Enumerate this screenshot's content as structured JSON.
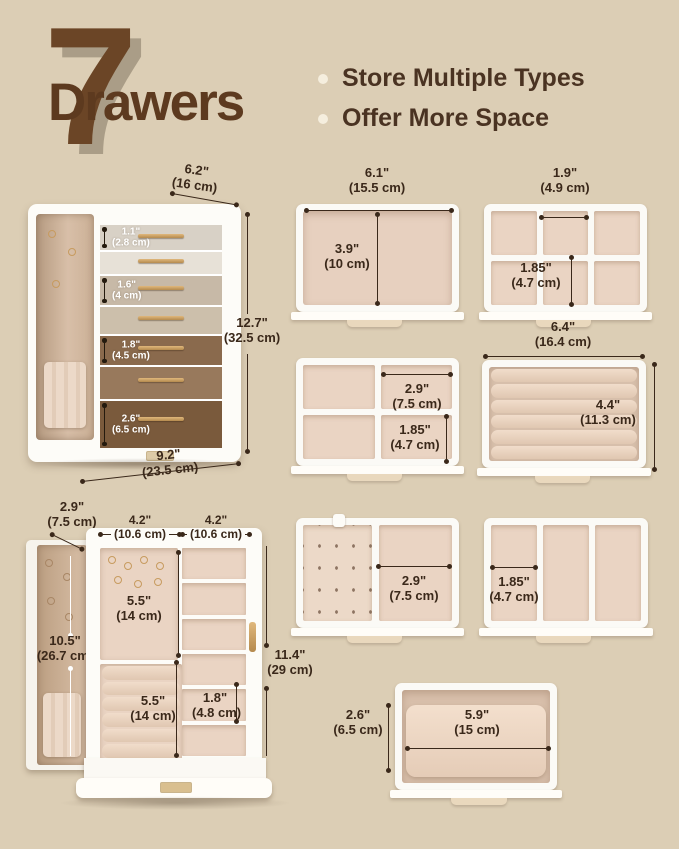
{
  "colors": {
    "background": "#dcceb5",
    "brown": "#5d3a1f",
    "line": "#3a281a",
    "velvet": "#ead4c3",
    "gold": "#c79b5f",
    "white": "#ffffff"
  },
  "header": {
    "number": "7",
    "word": "Drawers",
    "bullets": [
      {
        "label": "Store Multiple Types"
      },
      {
        "label": "Offer More Space"
      }
    ]
  },
  "closed_box": {
    "width_top": {
      "inch": "6.2\"",
      "cm": "(16 cm)"
    },
    "height": {
      "inch": "12.7\"",
      "cm": "(32.5 cm)"
    },
    "width_bottom": {
      "inch": "9.2\"",
      "cm": "(23.5 cm)"
    },
    "drawer_heights": [
      {
        "inch": "1.1\"",
        "cm": "(2.8 cm)"
      },
      {
        "inch": "1.6\"",
        "cm": "(4 cm)"
      },
      {
        "inch": "1.8\"",
        "cm": "(4.5 cm)"
      },
      {
        "inch": "2.6\"",
        "cm": "(6.5 cm)"
      }
    ]
  },
  "trays": {
    "tray1": {
      "width_inch": "6.1\"",
      "width_cm": "(15.5 cm)",
      "depth_inch": "3.9\"",
      "depth_cm": "(10 cm)"
    },
    "tray2": {
      "cell_width_inch": "1.9\"",
      "cell_width_cm": "(4.9 cm)",
      "cell_depth_inch": "1.85\"",
      "cell_depth_cm": "(4.7 cm)"
    },
    "tray3": {
      "cell_width_inch": "2.9\"",
      "cell_width_cm": "(7.5 cm)",
      "cell_depth_inch": "1.85\"",
      "cell_depth_cm": "(4.7 cm)"
    },
    "tray4": {
      "width_inch": "6.4\"",
      "width_cm": "(16.4 cm)",
      "depth_inch": "4.4\"",
      "depth_cm": "(11.3 cm)"
    },
    "tray5": {
      "cell_width_inch": "2.9\"",
      "cell_width_cm": "(7.5 cm)"
    },
    "tray6": {
      "cell_width_inch": "1.85\"",
      "cell_width_cm": "(4.7 cm)"
    },
    "tray7": {
      "height_inch": "2.6\"",
      "height_cm": "(6.5 cm)",
      "width_inch": "5.9\"",
      "width_cm": "(15 cm)"
    }
  },
  "open_box": {
    "door_width": {
      "inch": "2.9\"",
      "cm": "(7.5 cm)"
    },
    "left_width": {
      "inch": "4.2\"",
      "cm": "(10.6 cm)"
    },
    "right_width": {
      "inch": "4.2\"",
      "cm": "(10.6 cm)"
    },
    "hook_area_height": {
      "inch": "5.5\"",
      "cm": "(14 cm)"
    },
    "door_height": {
      "inch": "10.5\"",
      "cm": "(26.7 cm)"
    },
    "roll_area_height": {
      "inch": "5.5\"",
      "cm": "(14 cm)"
    },
    "shelf_height": {
      "inch": "1.8\"",
      "cm": "(4.8 cm)"
    },
    "total_height": {
      "inch": "11.4\"",
      "cm": "(29 cm)"
    }
  }
}
